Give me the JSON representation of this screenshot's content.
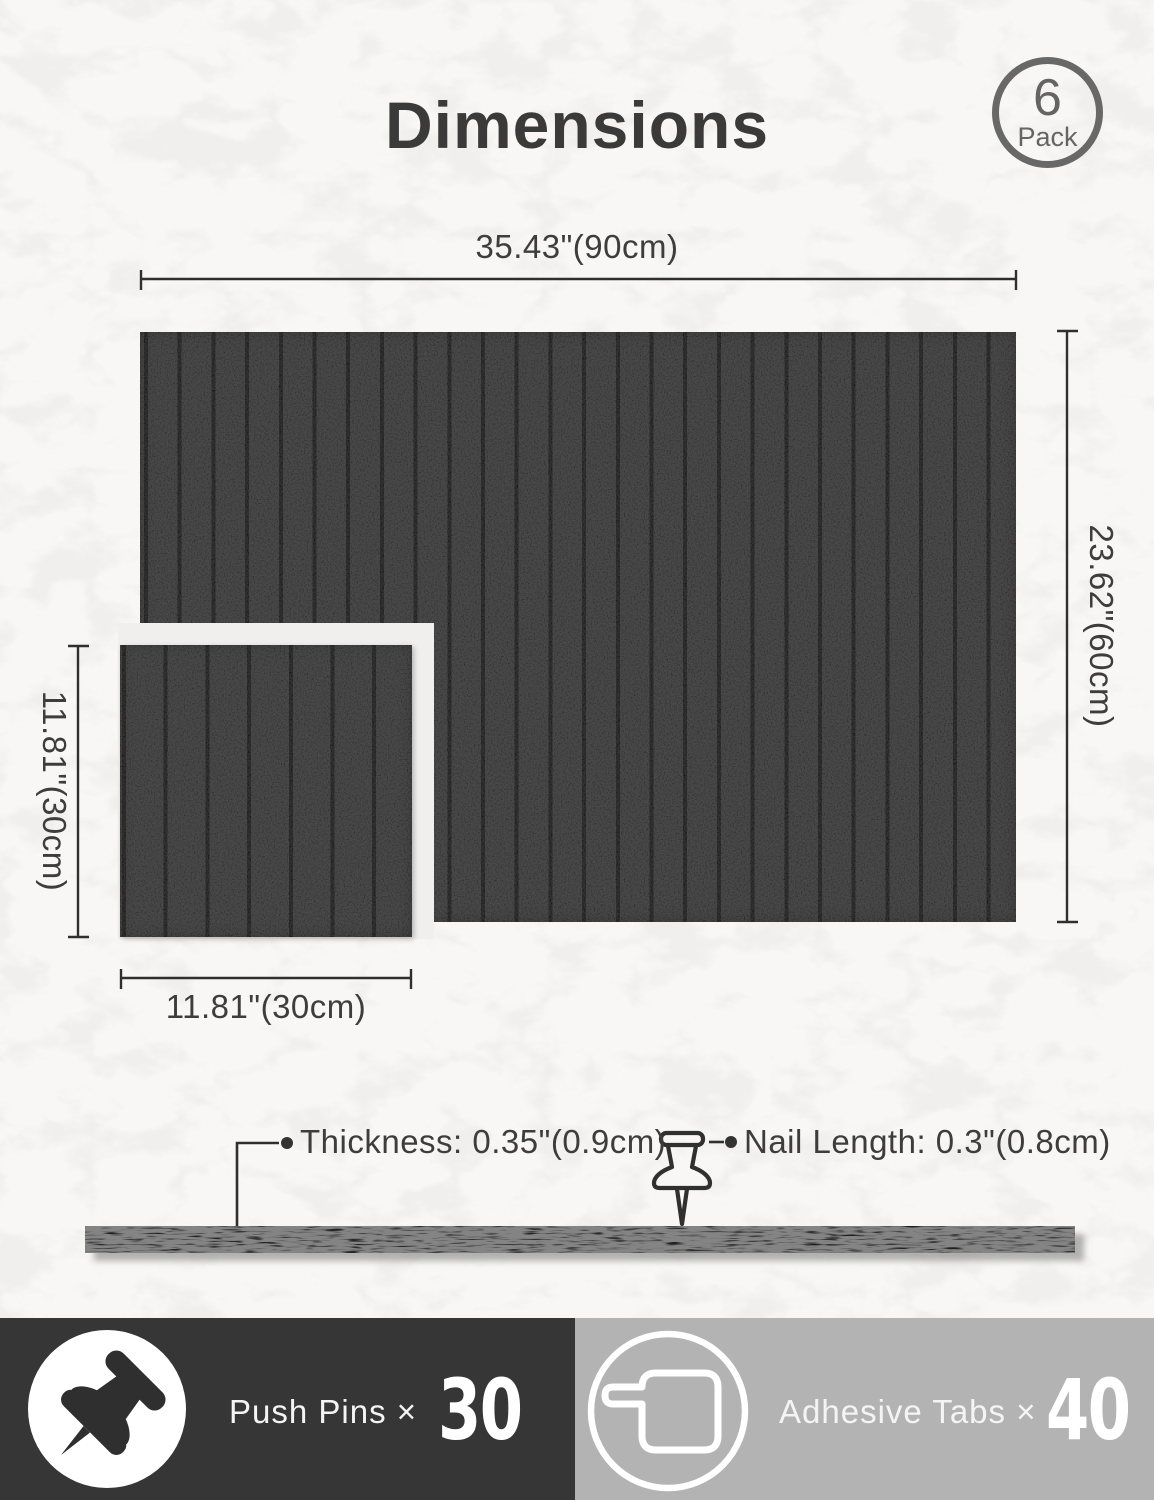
{
  "title": "Dimensions",
  "badge": {
    "count": "6",
    "label": "Pack"
  },
  "dims": {
    "large_width": "35.43\"(90cm)",
    "large_height": "23.62\"(60cm)",
    "small_height": "11.81\"(30cm)",
    "small_width": "11.81\"(30cm)"
  },
  "callouts": {
    "thickness": "Thickness: 0.35\"(0.9cm)",
    "nail_length": "Nail Length: 0.3\"(0.8cm)"
  },
  "footer": {
    "push_pins_label": "Push Pins ×",
    "push_pins_count": "30",
    "adhesive_tabs_label": "Adhesive Tabs ×",
    "adhesive_tabs_count": "40"
  },
  "colors": {
    "background": "#f0efed",
    "panel": "#2b2b2b",
    "groove": "#161616",
    "text": "#3d3d3d",
    "line": "#2f2f2f",
    "footer_left_bg": "#363636",
    "footer_right_bg": "#b3b3b3",
    "badge": "#686868",
    "count_text": "#ffffff"
  }
}
